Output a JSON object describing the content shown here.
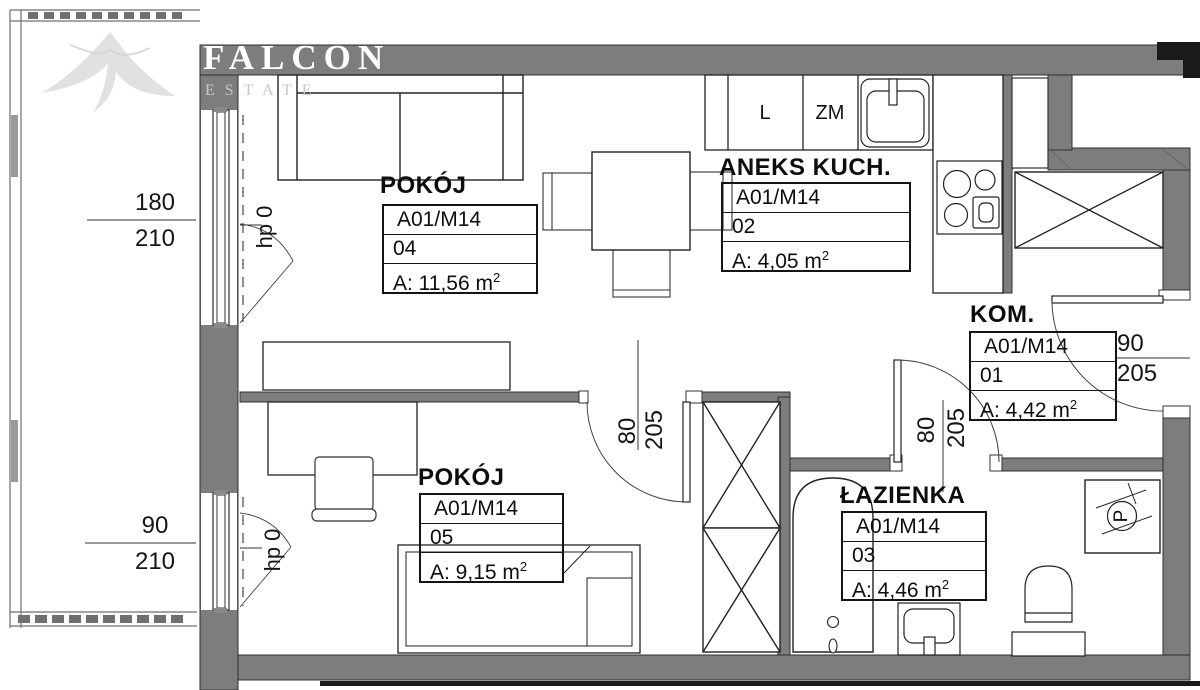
{
  "watermark": {
    "brand": "FALCON",
    "subtitle": "ESTATE"
  },
  "rooms": [
    {
      "title": "POKÓJ",
      "unit": "A01/M14",
      "number": "04",
      "area": "A: 11,56 m",
      "area_sup": "2"
    },
    {
      "title": "ANEKS KUCH.",
      "unit": "A01/M14",
      "number": "02",
      "area": "A: 4,05 m",
      "area_sup": "2"
    },
    {
      "title": "KOM.",
      "unit": "A01/M14",
      "number": "01",
      "area": "A: 4,42 m",
      "area_sup": "2"
    },
    {
      "title": "ŁAZIENKA",
      "unit": "A01/M14",
      "number": "03",
      "area": "A: 4,46 m",
      "area_sup": "2"
    },
    {
      "title": "POKÓJ",
      "unit": "A01/M14",
      "number": "05",
      "area": "A: 9,15 m",
      "area_sup": "2"
    }
  ],
  "kitchen": {
    "fridge_label": "L",
    "dishwasher_label": "ZM"
  },
  "bathroom": {
    "washer_label": "P"
  },
  "dimensions": {
    "window_top": {
      "width": "180",
      "height": "210",
      "sill": "hp 0"
    },
    "window_bottom": {
      "width": "90",
      "height": "210",
      "sill": "hp 0"
    },
    "door_room": {
      "width": "80",
      "height": "205"
    },
    "door_bathroom": {
      "width": "80",
      "height": "205"
    },
    "door_entry": {
      "width": "90",
      "height": "205"
    }
  },
  "colors": {
    "wall": "#7d7d7d",
    "line": "#222222",
    "watermark_text": "#ffffff",
    "watermark_sub": "#c6c6c6"
  }
}
